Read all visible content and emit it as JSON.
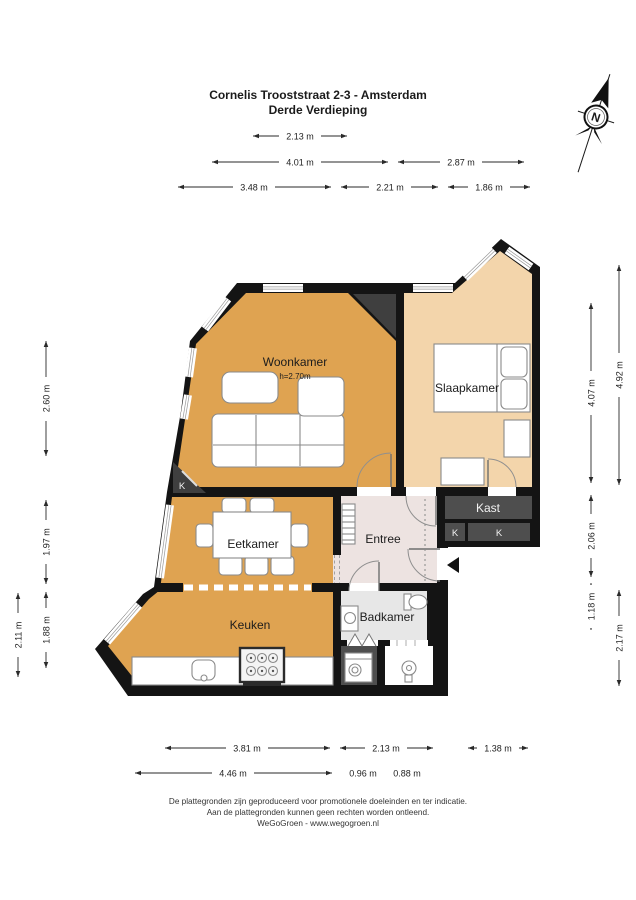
{
  "title": {
    "line1": "Cornelis Trooststraat 2-3 - Amsterdam",
    "line2": "Derde Verdieping"
  },
  "compass": {
    "label": "N"
  },
  "rooms": {
    "woonkamer": {
      "label": "Woonkamer",
      "height_note": "h=2.70m"
    },
    "slaapkamer": {
      "label": "Slaapkamer"
    },
    "eetkamer": {
      "label": "Eetkamer"
    },
    "keuken": {
      "label": "Keuken"
    },
    "entree": {
      "label": "Entree"
    },
    "badkamer": {
      "label": "Badkamer"
    },
    "kast": {
      "label": "Kast"
    },
    "closet_corner": {
      "label": "K"
    },
    "closet_k1": {
      "label": "K"
    },
    "closet_k2": {
      "label": "K"
    }
  },
  "dimensions": {
    "top": [
      {
        "label": "2.13 m"
      },
      {
        "label": "4.01 m"
      },
      {
        "label": "2.87 m"
      },
      {
        "label": "3.48 m"
      },
      {
        "label": "2.21 m"
      },
      {
        "label": "1.86 m"
      }
    ],
    "left": [
      {
        "label": "2.60 m"
      },
      {
        "label": "1.97 m"
      },
      {
        "label": "1.88 m"
      },
      {
        "label": "2.11 m"
      }
    ],
    "right": [
      {
        "label": "4.92 m"
      },
      {
        "label": "4.07 m"
      },
      {
        "label": "2.06 m"
      },
      {
        "label": "1.18 m"
      },
      {
        "label": "2.17 m"
      }
    ],
    "bottom": [
      {
        "label": "3.81 m"
      },
      {
        "label": "2.13 m"
      },
      {
        "label": "1.38 m"
      },
      {
        "label": "4.46 m"
      },
      {
        "label": "0.96 m"
      },
      {
        "label": "0.88 m"
      }
    ]
  },
  "footer": {
    "line1": "De plattegronden zijn geproduceerd voor promotionele doeleinden en ter indicatie.",
    "line2": "Aan de plattegronden kunnen geen rechten worden ontleend.",
    "line3": "WeGoGroen -  www.wegogroen.nl"
  },
  "colors": {
    "wall": "#141414",
    "living_orange": "#DFA351",
    "bedroom_peach": "#F3D5AB",
    "entree_pink": "#EDE3E1",
    "bath_gray": "#E7E7E7",
    "closet_dark": "#4E4E4E",
    "shaft_dark": "#3F3F3F"
  }
}
